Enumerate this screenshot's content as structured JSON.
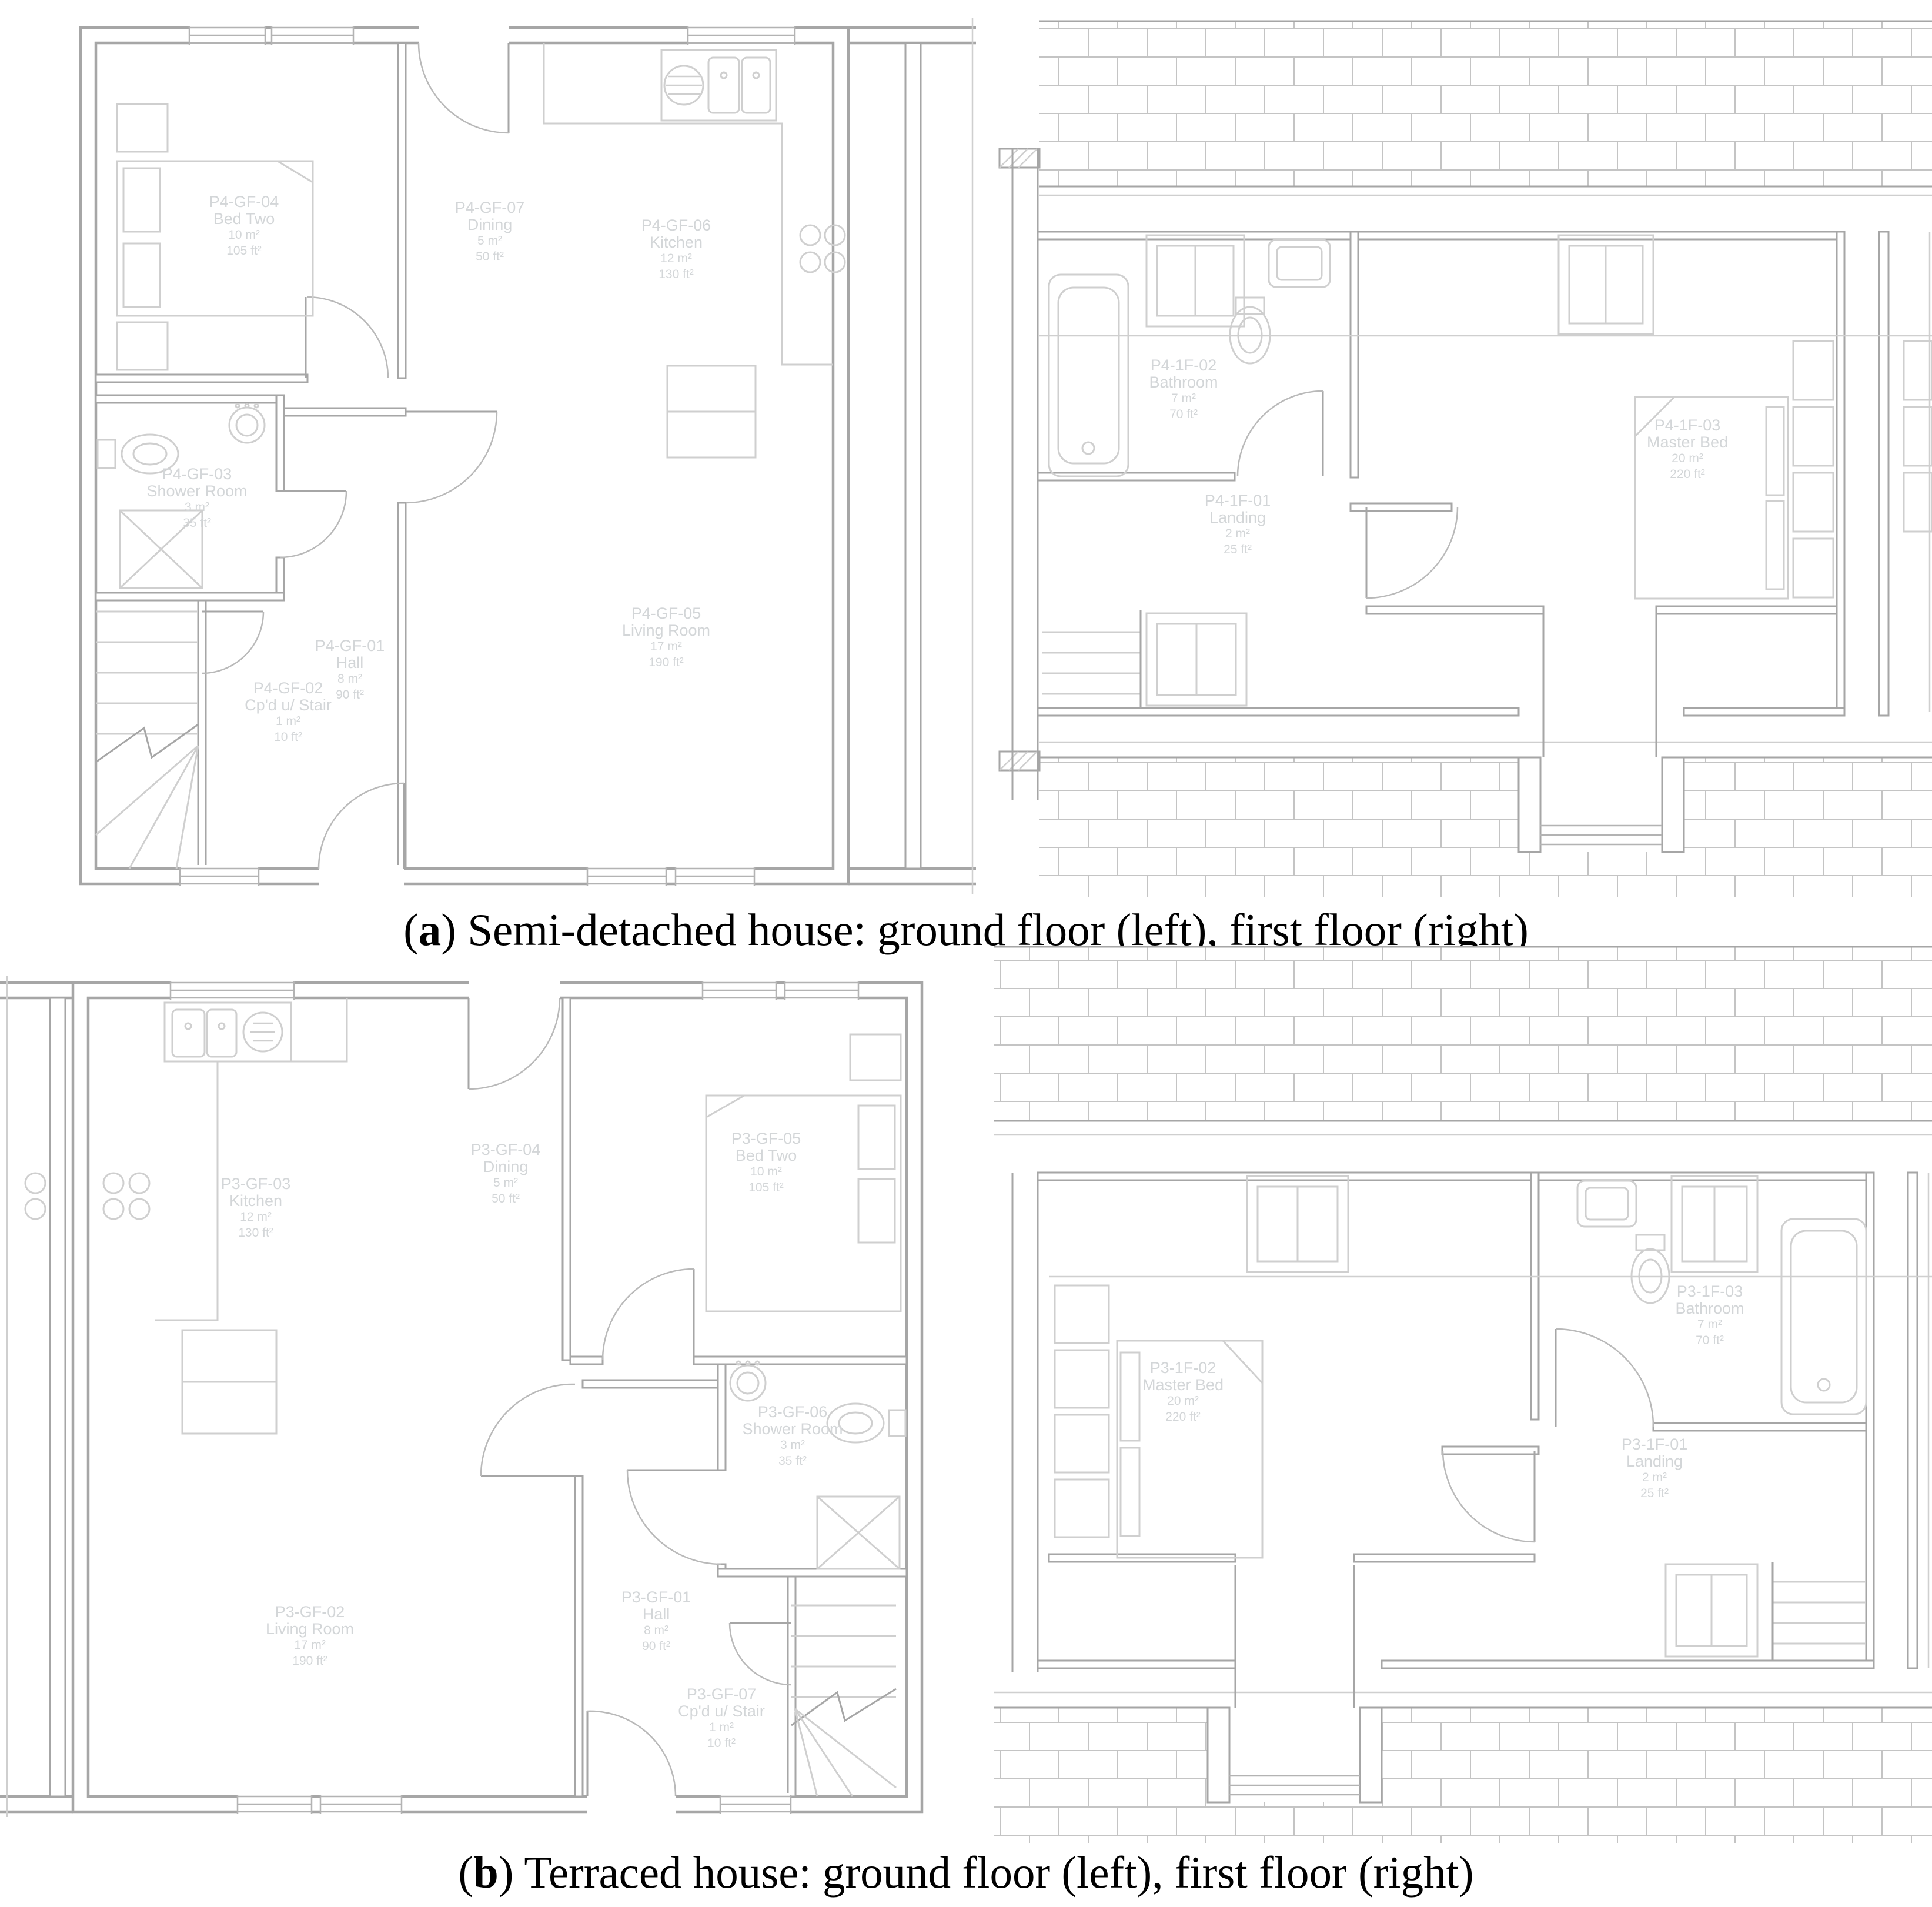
{
  "figure": {
    "captions": {
      "a": {
        "open": "(",
        "letter": "a",
        "close": ")",
        "text": " Semi-detached house: ground floor (left), first floor (right)"
      },
      "b": {
        "open": "(",
        "letter": "b",
        "close": ")",
        "text": " Terraced house: ground floor (left), first floor (right)"
      }
    }
  },
  "colors": {
    "wall_line": "#a6a6a6",
    "thin_line": "#cfcfcf",
    "room_label": "#d3d6d8",
    "brick_line": "#c4c4c4",
    "caption_text": "#000000",
    "background": "#ffffff"
  },
  "panels": {
    "semi_ground": {
      "title": "Semi-detached ground floor",
      "rooms": [
        {
          "id": "P4-GF-01",
          "label": "Hall",
          "area_m2": "8 m²",
          "area_ft2": "90 ft²"
        },
        {
          "id": "P4-GF-02",
          "label": "Cp'd u/ Stair",
          "area_m2": "1 m²",
          "area_ft2": "10 ft²"
        },
        {
          "id": "P4-GF-03",
          "label": "Shower Room",
          "area_m2": "3 m²",
          "area_ft2": "35 ft²"
        },
        {
          "id": "P4-GF-04",
          "label": "Bed Two",
          "area_m2": "10 m²",
          "area_ft2": "105 ft²"
        },
        {
          "id": "P4-GF-05",
          "label": "Living Room",
          "area_m2": "17 m²",
          "area_ft2": "190 ft²"
        },
        {
          "id": "P4-GF-06",
          "label": "Kitchen",
          "area_m2": "12 m²",
          "area_ft2": "130 ft²"
        },
        {
          "id": "P4-GF-07",
          "label": "Dining",
          "area_m2": "5 m²",
          "area_ft2": "50 ft²"
        }
      ]
    },
    "semi_first": {
      "title": "Semi-detached first floor",
      "rooms": [
        {
          "id": "P4-1F-01",
          "label": "Landing",
          "area_m2": "2 m²",
          "area_ft2": "25 ft²"
        },
        {
          "id": "P4-1F-02",
          "label": "Bathroom",
          "area_m2": "7 m²",
          "area_ft2": "70 ft²"
        },
        {
          "id": "P4-1F-03",
          "label": "Master Bed",
          "area_m2": "20 m²",
          "area_ft2": "220 ft²"
        }
      ]
    },
    "terraced_ground": {
      "title": "Terraced ground floor",
      "rooms": [
        {
          "id": "P3-GF-01",
          "label": "Hall",
          "area_m2": "8 m²",
          "area_ft2": "90 ft²"
        },
        {
          "id": "P3-GF-02",
          "label": "Living Room",
          "area_m2": "17 m²",
          "area_ft2": "190 ft²"
        },
        {
          "id": "P3-GF-03",
          "label": "Kitchen",
          "area_m2": "12 m²",
          "area_ft2": "130 ft²"
        },
        {
          "id": "P3-GF-04",
          "label": "Dining",
          "area_m2": "5 m²",
          "area_ft2": "50 ft²"
        },
        {
          "id": "P3-GF-05",
          "label": "Bed Two",
          "area_m2": "10 m²",
          "area_ft2": "105 ft²"
        },
        {
          "id": "P3-GF-06",
          "label": "Shower Room",
          "area_m2": "3 m²",
          "area_ft2": "35 ft²"
        },
        {
          "id": "P3-GF-07",
          "label": "Cp'd u/ Stair",
          "area_m2": "1 m²",
          "area_ft2": "10 ft²"
        }
      ]
    },
    "terraced_first": {
      "title": "Terraced first floor",
      "rooms": [
        {
          "id": "P3-1F-01",
          "label": "Landing",
          "area_m2": "2 m²",
          "area_ft2": "25 ft²"
        },
        {
          "id": "P3-1F-02",
          "label": "Master Bed",
          "area_m2": "20 m²",
          "area_ft2": "220 ft²"
        },
        {
          "id": "P3-1F-03",
          "label": "Bathroom",
          "area_m2": "7 m²",
          "area_ft2": "70 ft²"
        }
      ]
    }
  }
}
